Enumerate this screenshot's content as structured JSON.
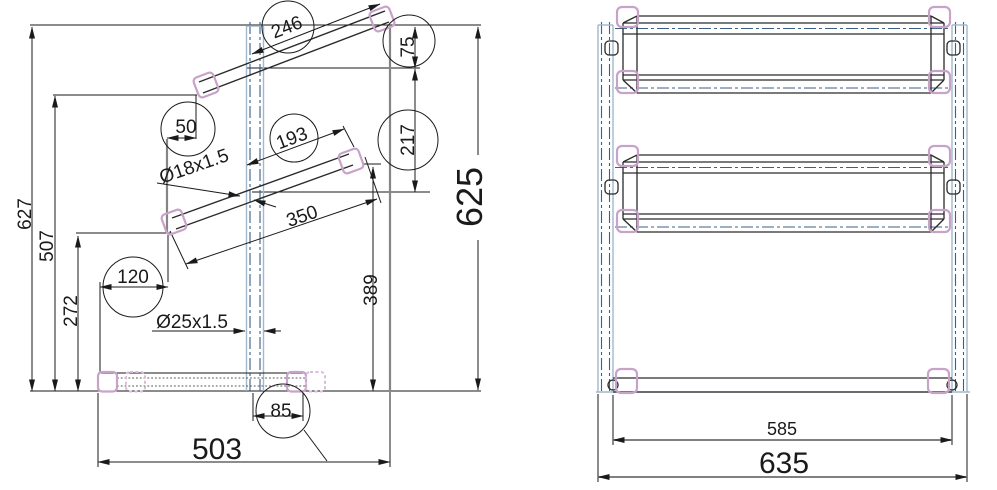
{
  "side": {
    "d627": "627",
    "d507": "507",
    "d272": "272",
    "d120": "120",
    "d50": "50",
    "d246": "246",
    "d75": "75",
    "d217": "217",
    "d193": "193",
    "d350": "350",
    "d389": "389",
    "d625": "625",
    "d503": "503",
    "d85": "85",
    "tube18": "Ø18x1.5",
    "tube25": "Ø25x1.5"
  },
  "front": {
    "d585": "585",
    "d635": "635"
  },
  "colors": {
    "line_black": "#1a1a1a",
    "structural_gray": "#858585",
    "pink_cap": "#c9a2c9",
    "pink_cap_dashed": "#d8bcd8",
    "post_blue": "#9fb8cc",
    "centerline_blue": "#3a5f88"
  }
}
